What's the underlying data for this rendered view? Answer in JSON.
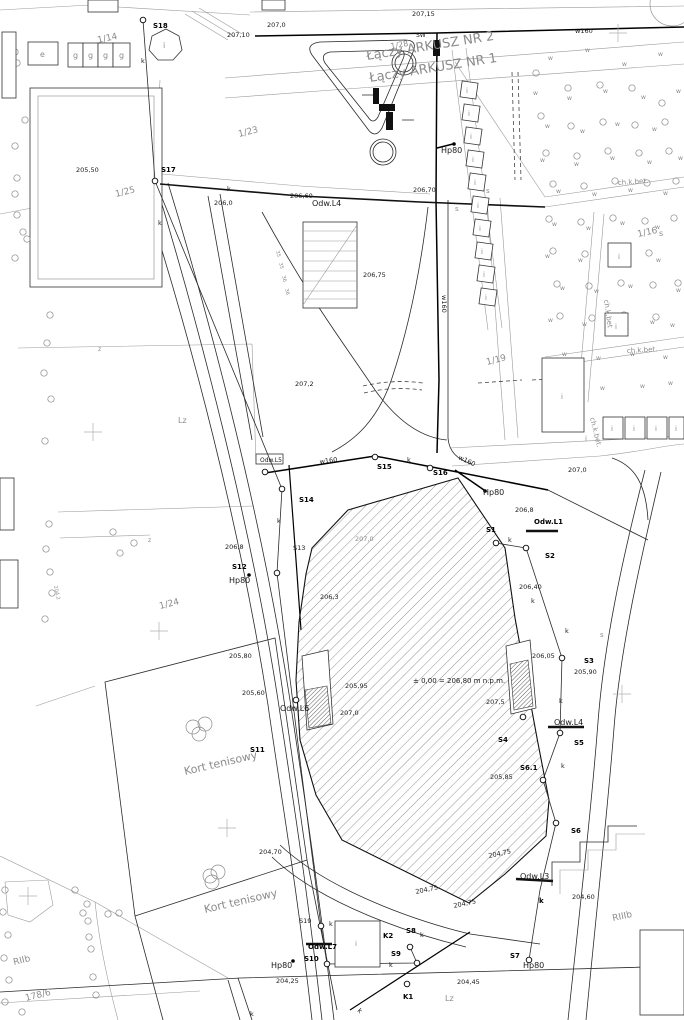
{
  "meta": {
    "map_type": "geodetic site plan",
    "language": "pl"
  },
  "colors": {
    "background": "#ffffff",
    "ink": "#1a1a1a",
    "muted": "#8b8b8b"
  },
  "sheet_join": {
    "upper": "Łączy ARKUSZ NR 2",
    "lower": "Łączy ARKUSZ NR 1"
  },
  "level_note": "± 0,00 = 206,80 m n.p.m.",
  "labels": [
    {
      "t": "207,10",
      "x": 227,
      "y": 37
    },
    {
      "t": "207,0",
      "x": 267,
      "y": 27
    },
    {
      "t": "207,15",
      "x": 412,
      "y": 16
    },
    {
      "t": "SW",
      "x": 416,
      "y": 37,
      "s": 6
    },
    {
      "t": "w160",
      "x": 575,
      "y": 33
    },
    {
      "t": "1/14",
      "x": 98,
      "y": 43,
      "r": -12,
      "s": 9,
      "g": 1
    },
    {
      "t": "1/28",
      "x": 391,
      "y": 49,
      "r": -10,
      "s": 8,
      "g": 1
    },
    {
      "t": "S18",
      "x": 153,
      "y": 28,
      "b": 1
    },
    {
      "t": "k",
      "x": 141,
      "y": 63
    },
    {
      "t": "e",
      "x": 40,
      "y": 57,
      "s": 8,
      "g": 1
    },
    {
      "t": "g",
      "x": 73,
      "y": 58,
      "s": 8,
      "g": 1
    },
    {
      "t": "g",
      "x": 88,
      "y": 58,
      "s": 8,
      "g": 1
    },
    {
      "t": "g",
      "x": 103,
      "y": 58,
      "s": 8,
      "g": 1
    },
    {
      "t": "g",
      "x": 119,
      "y": 58,
      "s": 8,
      "g": 1
    },
    {
      "t": "i",
      "x": 163,
      "y": 48,
      "s": 8,
      "g": 1
    },
    {
      "t": "Łączy ARKUSZ NR 2",
      "x": 367,
      "y": 60,
      "r": -9,
      "s": 13,
      "g": 1
    },
    {
      "t": "Łączy ARKUSZ NR 1",
      "x": 370,
      "y": 82,
      "r": -9,
      "s": 13,
      "g": 1
    },
    {
      "t": "205,50",
      "x": 76,
      "y": 172
    },
    {
      "t": "1/25",
      "x": 116,
      "y": 197,
      "r": -14,
      "s": 9,
      "g": 1
    },
    {
      "t": "S17",
      "x": 161,
      "y": 172,
      "b": 1
    },
    {
      "t": "k",
      "x": 227,
      "y": 191
    },
    {
      "t": "k",
      "x": 158,
      "y": 225
    },
    {
      "t": "206,0",
      "x": 214,
      "y": 205
    },
    {
      "t": "206,60",
      "x": 290,
      "y": 198
    },
    {
      "t": "Odw.L4",
      "x": 312,
      "y": 206,
      "s": 8
    },
    {
      "t": "206,70",
      "x": 413,
      "y": 192
    },
    {
      "t": "Hp80",
      "x": 441,
      "y": 153,
      "s": 8
    },
    {
      "t": "1/23",
      "x": 239,
      "y": 137,
      "r": -14,
      "s": 9,
      "g": 1
    },
    {
      "t": "ch.k.bet.",
      "x": 618,
      "y": 185,
      "r": -4,
      "s": 7,
      "g": 1
    },
    {
      "t": "206,75",
      "x": 363,
      "y": 277
    },
    {
      "t": "w160",
      "x": 442,
      "y": 295,
      "r": 90
    },
    {
      "t": "207,2",
      "x": 295,
      "y": 386
    },
    {
      "t": "1/16",
      "x": 638,
      "y": 237,
      "r": -12,
      "s": 9,
      "g": 1
    },
    {
      "t": "1/19",
      "x": 487,
      "y": 365,
      "r": -14,
      "s": 9,
      "g": 1
    },
    {
      "t": "ch.k.bet",
      "x": 604,
      "y": 300,
      "r": 82,
      "s": 7,
      "g": 1
    },
    {
      "t": "ch.k.bet.",
      "x": 627,
      "y": 353,
      "r": -3,
      "s": 7,
      "g": 1
    },
    {
      "t": "ch.k.bet.",
      "x": 590,
      "y": 418,
      "r": 76,
      "s": 7,
      "g": 1
    },
    {
      "t": "Lz",
      "x": 178,
      "y": 423,
      "s": 8,
      "g": 1
    },
    {
      "t": "z",
      "x": 98,
      "y": 351,
      "s": 6,
      "g": 1
    },
    {
      "t": "z",
      "x": 148,
      "y": 542,
      "s": 6,
      "g": 1
    },
    {
      "t": "35",
      "x": 276,
      "y": 251,
      "r": 76,
      "s": 5,
      "g": 1
    },
    {
      "t": "35",
      "x": 279,
      "y": 263,
      "r": 76,
      "s": 5,
      "g": 1
    },
    {
      "t": "36",
      "x": 282,
      "y": 276,
      "r": 76,
      "s": 5,
      "g": 1
    },
    {
      "t": "36",
      "x": 285,
      "y": 289,
      "r": 76,
      "s": 5,
      "g": 1
    },
    {
      "t": "Odw.L5",
      "x": 260,
      "y": 462,
      "s": 6
    },
    {
      "t": "w160",
      "x": 320,
      "y": 464,
      "r": -8
    },
    {
      "t": "S15",
      "x": 377,
      "y": 469,
      "b": 1
    },
    {
      "t": "k",
      "x": 407,
      "y": 462
    },
    {
      "t": "S16",
      "x": 433,
      "y": 475,
      "b": 1
    },
    {
      "t": "w160",
      "x": 458,
      "y": 459,
      "r": 25
    },
    {
      "t": "207,0",
      "x": 568,
      "y": 472
    },
    {
      "t": "Hp80",
      "x": 483,
      "y": 495,
      "s": 8
    },
    {
      "t": "S14",
      "x": 299,
      "y": 502,
      "b": 1
    },
    {
      "t": "206,8",
      "x": 515,
      "y": 512
    },
    {
      "t": "Odw.L1",
      "x": 534,
      "y": 524,
      "b": 1,
      "s": 7
    },
    {
      "t": "S1",
      "x": 486,
      "y": 532,
      "b": 1
    },
    {
      "t": "k",
      "x": 508,
      "y": 542
    },
    {
      "t": "S2",
      "x": 545,
      "y": 558,
      "b": 1
    },
    {
      "t": "S13",
      "x": 293,
      "y": 550
    },
    {
      "t": "k",
      "x": 277,
      "y": 523
    },
    {
      "t": "206,8",
      "x": 225,
      "y": 549
    },
    {
      "t": "S12",
      "x": 232,
      "y": 569,
      "b": 1
    },
    {
      "t": "Hp80",
      "x": 229,
      "y": 583,
      "s": 8
    },
    {
      "t": "206,40",
      "x": 519,
      "y": 589
    },
    {
      "t": "k",
      "x": 531,
      "y": 603
    },
    {
      "t": "207,0",
      "x": 355,
      "y": 541,
      "g": 1
    },
    {
      "t": "206,3",
      "x": 320,
      "y": 599
    },
    {
      "t": "1/24",
      "x": 160,
      "y": 609,
      "r": -14,
      "s": 9,
      "g": 1
    },
    {
      "t": "204,2",
      "x": 54,
      "y": 586,
      "r": 78,
      "s": 5,
      "g": 1
    },
    {
      "t": "205,95",
      "x": 345,
      "y": 688
    },
    {
      "t": "207,0",
      "x": 340,
      "y": 715
    },
    {
      "t": "± 0,00 = 206,80 m n.p.m.",
      "x": 413,
      "y": 683,
      "s": 7
    },
    {
      "t": "207,5",
      "x": 486,
      "y": 704
    },
    {
      "t": "206,05",
      "x": 532,
      "y": 658
    },
    {
      "t": "205,90",
      "x": 574,
      "y": 674
    },
    {
      "t": "S3",
      "x": 584,
      "y": 663,
      "b": 1
    },
    {
      "t": "k",
      "x": 565,
      "y": 633
    },
    {
      "t": "205,80",
      "x": 229,
      "y": 658
    },
    {
      "t": "205,60",
      "x": 242,
      "y": 695
    },
    {
      "t": "Odw.L6",
      "x": 280,
      "y": 711,
      "s": 8
    },
    {
      "t": "S11",
      "x": 250,
      "y": 752,
      "b": 1
    },
    {
      "t": "Kort tenisowy",
      "x": 185,
      "y": 775,
      "r": -13,
      "s": 11,
      "g": 1
    },
    {
      "t": "Odw.L4",
      "x": 554,
      "y": 725,
      "s": 8
    },
    {
      "t": "S4",
      "x": 498,
      "y": 742,
      "b": 1
    },
    {
      "t": "S5",
      "x": 574,
      "y": 745,
      "b": 1
    },
    {
      "t": "k",
      "x": 559,
      "y": 703
    },
    {
      "t": "S6.1",
      "x": 520,
      "y": 770,
      "b": 1
    },
    {
      "t": "205,85",
      "x": 490,
      "y": 779
    },
    {
      "t": "k",
      "x": 561,
      "y": 768
    },
    {
      "t": "S6",
      "x": 571,
      "y": 833,
      "b": 1
    },
    {
      "t": "204,70",
      "x": 259,
      "y": 854
    },
    {
      "t": "204,75",
      "x": 416,
      "y": 894,
      "r": -12
    },
    {
      "t": "204,75",
      "x": 489,
      "y": 858,
      "r": -12
    },
    {
      "t": "204,75",
      "x": 454,
      "y": 908,
      "r": -12
    },
    {
      "t": "Odw.L3",
      "x": 520,
      "y": 879,
      "s": 8
    },
    {
      "t": "k",
      "x": 539,
      "y": 903,
      "b": 1
    },
    {
      "t": "204,60",
      "x": 572,
      "y": 899
    },
    {
      "t": "RIIIb",
      "x": 613,
      "y": 921,
      "r": -12,
      "s": 9,
      "g": 1
    },
    {
      "t": "S19",
      "x": 299,
      "y": 923
    },
    {
      "t": "k",
      "x": 329,
      "y": 926
    },
    {
      "t": "Odw.L7",
      "x": 308,
      "y": 949,
      "b": 1,
      "s": 7
    },
    {
      "t": "S10",
      "x": 304,
      "y": 961,
      "b": 1
    },
    {
      "t": "Hp80",
      "x": 271,
      "y": 968,
      "s": 8
    },
    {
      "t": "204,25",
      "x": 276,
      "y": 983
    },
    {
      "t": "K2",
      "x": 383,
      "y": 938,
      "b": 1
    },
    {
      "t": "S8",
      "x": 406,
      "y": 933,
      "b": 1
    },
    {
      "t": "k",
      "x": 420,
      "y": 937
    },
    {
      "t": "S9",
      "x": 391,
      "y": 956,
      "b": 1
    },
    {
      "t": "k",
      "x": 389,
      "y": 967
    },
    {
      "t": "K1",
      "x": 403,
      "y": 999,
      "b": 1
    },
    {
      "t": "k",
      "x": 357,
      "y": 1011,
      "r": 45
    },
    {
      "t": "k",
      "x": 250,
      "y": 1016
    },
    {
      "t": "Lz",
      "x": 445,
      "y": 1001,
      "s": 8,
      "g": 1
    },
    {
      "t": "204,45",
      "x": 457,
      "y": 984
    },
    {
      "t": "Kort tenisowy",
      "x": 205,
      "y": 913,
      "r": -13,
      "s": 11,
      "g": 1
    },
    {
      "t": "RIIb",
      "x": 14,
      "y": 965,
      "r": -14,
      "s": 9,
      "g": 1
    },
    {
      "t": "178/6",
      "x": 26,
      "y": 1001,
      "r": -14,
      "s": 9,
      "g": 1
    },
    {
      "t": "S7",
      "x": 510,
      "y": 958,
      "b": 1
    },
    {
      "t": "Hp80",
      "x": 523,
      "y": 968,
      "s": 8
    },
    {
      "t": "s",
      "x": 486,
      "y": 193,
      "s": 7,
      "g": 1
    },
    {
      "t": "s",
      "x": 455,
      "y": 211,
      "s": 7,
      "g": 1
    },
    {
      "t": "s",
      "x": 659,
      "y": 236,
      "s": 8,
      "g": 1
    },
    {
      "t": "s",
      "x": 600,
      "y": 637,
      "s": 7,
      "g": 1
    },
    {
      "t": "i",
      "x": 466,
      "y": 93,
      "s": 7,
      "g": 1
    },
    {
      "t": "i",
      "x": 468,
      "y": 116,
      "s": 7,
      "g": 1
    },
    {
      "t": "i",
      "x": 470,
      "y": 139,
      "s": 7,
      "g": 1
    },
    {
      "t": "i",
      "x": 472,
      "y": 162,
      "s": 7,
      "g": 1
    },
    {
      "t": "i",
      "x": 474,
      "y": 185,
      "s": 7,
      "g": 1
    },
    {
      "t": "i",
      "x": 477,
      "y": 208,
      "s": 7,
      "g": 1
    },
    {
      "t": "i",
      "x": 479,
      "y": 231,
      "s": 7,
      "g": 1
    },
    {
      "t": "i",
      "x": 481,
      "y": 254,
      "s": 7,
      "g": 1
    },
    {
      "t": "i",
      "x": 483,
      "y": 277,
      "s": 7,
      "g": 1
    },
    {
      "t": "i",
      "x": 485,
      "y": 300,
      "s": 7,
      "g": 1
    },
    {
      "t": "i",
      "x": 618,
      "y": 259,
      "s": 7,
      "g": 1
    },
    {
      "t": "i",
      "x": 615,
      "y": 329,
      "s": 7,
      "g": 1
    },
    {
      "t": "i",
      "x": 561,
      "y": 399,
      "s": 7,
      "g": 1
    },
    {
      "t": "i",
      "x": 585,
      "y": 441,
      "s": 7,
      "g": 1
    },
    {
      "t": "i",
      "x": 611,
      "y": 431,
      "s": 7,
      "g": 1
    },
    {
      "t": "i",
      "x": 633,
      "y": 431,
      "s": 7,
      "g": 1
    },
    {
      "t": "i",
      "x": 655,
      "y": 431,
      "s": 7,
      "g": 1
    },
    {
      "t": "i",
      "x": 675,
      "y": 431,
      "s": 7,
      "g": 1
    },
    {
      "t": "i",
      "x": 355,
      "y": 946,
      "s": 7,
      "g": 1
    }
  ],
  "tree_marks": {
    "glyph": "w",
    "positions": [
      [
        548,
        60
      ],
      [
        585,
        52
      ],
      [
        622,
        66
      ],
      [
        658,
        56
      ],
      [
        533,
        95
      ],
      [
        567,
        100
      ],
      [
        603,
        93
      ],
      [
        641,
        99
      ],
      [
        676,
        93
      ],
      [
        545,
        128
      ],
      [
        580,
        133
      ],
      [
        615,
        126
      ],
      [
        652,
        131
      ],
      [
        540,
        162
      ],
      [
        574,
        166
      ],
      [
        610,
        160
      ],
      [
        647,
        164
      ],
      [
        678,
        160
      ],
      [
        556,
        193
      ],
      [
        592,
        196
      ],
      [
        628,
        192
      ],
      [
        663,
        195
      ],
      [
        552,
        226
      ],
      [
        586,
        230
      ],
      [
        620,
        225
      ],
      [
        655,
        229
      ],
      [
        545,
        258
      ],
      [
        578,
        262
      ],
      [
        612,
        257
      ],
      [
        560,
        290
      ],
      [
        594,
        293
      ],
      [
        628,
        288
      ],
      [
        656,
        262
      ],
      [
        548,
        322
      ],
      [
        582,
        326
      ],
      [
        616,
        321
      ],
      [
        650,
        324
      ],
      [
        676,
        292
      ],
      [
        670,
        327
      ],
      [
        562,
        356
      ],
      [
        596,
        360
      ],
      [
        630,
        356
      ],
      [
        663,
        359
      ],
      [
        572,
        385
      ],
      [
        600,
        390
      ],
      [
        640,
        388
      ],
      [
        668,
        385
      ]
    ]
  },
  "trees": [
    [
      15,
      52
    ],
    [
      17,
      63
    ],
    [
      25,
      120
    ],
    [
      15,
      146
    ],
    [
      17,
      178
    ],
    [
      15,
      194
    ],
    [
      17,
      215
    ],
    [
      23,
      232
    ],
    [
      27,
      239
    ],
    [
      15,
      258
    ],
    [
      50,
      315
    ],
    [
      47,
      343
    ],
    [
      44,
      373
    ],
    [
      51,
      399
    ],
    [
      45,
      441
    ],
    [
      49,
      524
    ],
    [
      46,
      549
    ],
    [
      52,
      593
    ],
    [
      45,
      619
    ],
    [
      50,
      572
    ],
    [
      113,
      532
    ],
    [
      134,
      543
    ],
    [
      120,
      553
    ],
    [
      536,
      73
    ],
    [
      568,
      88
    ],
    [
      600,
      85
    ],
    [
      632,
      88
    ],
    [
      662,
      103
    ],
    [
      541,
      116
    ],
    [
      571,
      126
    ],
    [
      603,
      122
    ],
    [
      635,
      125
    ],
    [
      665,
      122
    ],
    [
      546,
      153
    ],
    [
      577,
      156
    ],
    [
      608,
      151
    ],
    [
      639,
      153
    ],
    [
      669,
      151
    ],
    [
      553,
      184
    ],
    [
      584,
      186
    ],
    [
      615,
      181
    ],
    [
      647,
      183
    ],
    [
      676,
      181
    ],
    [
      549,
      219
    ],
    [
      581,
      222
    ],
    [
      613,
      218
    ],
    [
      645,
      221
    ],
    [
      674,
      218
    ],
    [
      553,
      251
    ],
    [
      585,
      254
    ],
    [
      617,
      250
    ],
    [
      649,
      253
    ],
    [
      557,
      284
    ],
    [
      589,
      286
    ],
    [
      621,
      283
    ],
    [
      653,
      285
    ],
    [
      678,
      283
    ],
    [
      560,
      316
    ],
    [
      592,
      318
    ],
    [
      624,
      315
    ],
    [
      656,
      317
    ],
    [
      75,
      890
    ],
    [
      87,
      904
    ],
    [
      83,
      913
    ],
    [
      88,
      921
    ],
    [
      108,
      914
    ],
    [
      119,
      913
    ],
    [
      89,
      937
    ],
    [
      91,
      949
    ],
    [
      93,
      977
    ],
    [
      96,
      995
    ],
    [
      5,
      890
    ],
    [
      3,
      912
    ],
    [
      8,
      935
    ],
    [
      4,
      958
    ],
    [
      9,
      980
    ],
    [
      5,
      1002
    ],
    [
      22,
      1012
    ]
  ],
  "court_circles": [
    [
      193,
      727
    ],
    [
      205,
      724
    ],
    [
      199,
      734
    ],
    [
      210,
      876
    ],
    [
      218,
      872
    ],
    [
      212,
      882
    ]
  ],
  "survey_points": [
    [
      143,
      20
    ],
    [
      155,
      181
    ],
    [
      265,
      472
    ],
    [
      282,
      489
    ],
    [
      277,
      573
    ],
    [
      375,
      457
    ],
    [
      430,
      468
    ],
    [
      496,
      543
    ],
    [
      526,
      548
    ],
    [
      562,
      658
    ],
    [
      523,
      717
    ],
    [
      560,
      733
    ],
    [
      543,
      780
    ],
    [
      556,
      823
    ],
    [
      321,
      926
    ],
    [
      327,
      964
    ],
    [
      410,
      947
    ],
    [
      417,
      963
    ],
    [
      407,
      984
    ],
    [
      529,
      960
    ],
    [
      296,
      700
    ]
  ],
  "dots": [
    [
      454,
      144
    ],
    [
      485,
      491
    ],
    [
      293,
      961
    ],
    [
      249,
      575
    ]
  ],
  "grid_crosses": [
    [
      93,
      432
    ],
    [
      159,
      631
    ],
    [
      227,
      828
    ],
    [
      28,
      896
    ],
    [
      622,
      694
    ],
    [
      618,
      33
    ]
  ],
  "building_squares": [
    [
      469,
      90
    ],
    [
      471,
      113
    ],
    [
      473,
      136
    ],
    [
      475,
      159
    ],
    [
      477,
      182
    ],
    [
      480,
      205
    ],
    [
      482,
      228
    ],
    [
      484,
      251
    ],
    [
      486,
      274
    ],
    [
      488,
      297
    ]
  ],
  "building_rects": [
    [
      28,
      42,
      30,
      23
    ],
    [
      68,
      43,
      15,
      24
    ],
    [
      83,
      43,
      15,
      24
    ],
    [
      98,
      43,
      15,
      24
    ],
    [
      113,
      43,
      17,
      24
    ],
    [
      88,
      0,
      30,
      12
    ],
    [
      262,
      0,
      23,
      10
    ],
    [
      2,
      32,
      14,
      66
    ],
    [
      0,
      478,
      14,
      52
    ],
    [
      0,
      560,
      18,
      48
    ],
    [
      542,
      358,
      42,
      74
    ],
    [
      608,
      243,
      23,
      24
    ],
    [
      605,
      313,
      23,
      23
    ],
    [
      603,
      417,
      20,
      22
    ],
    [
      625,
      417,
      20,
      22
    ],
    [
      647,
      417,
      20,
      22
    ],
    [
      669,
      417,
      15,
      22
    ],
    [
      640,
      930,
      44,
      85
    ],
    [
      335,
      921,
      45,
      46
    ]
  ]
}
